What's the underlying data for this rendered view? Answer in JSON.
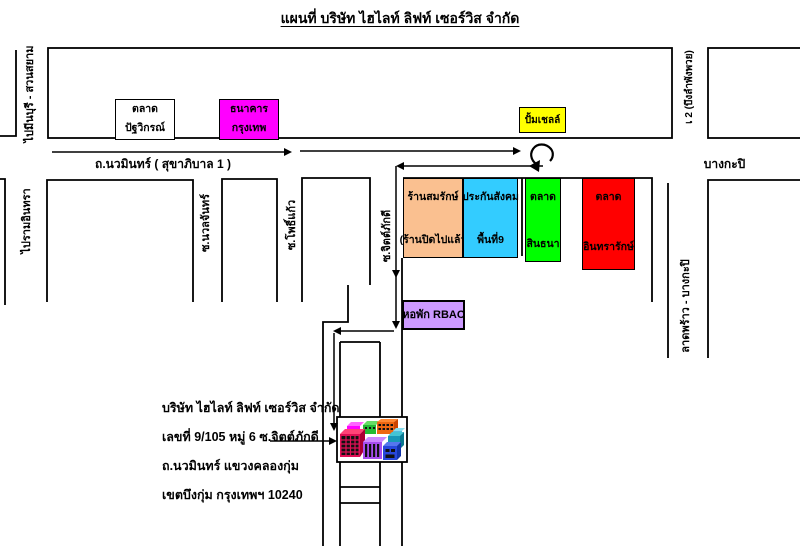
{
  "title": "แผนที่ บริษัท ไฮไลท์ ลิฟท์ เซอร์วิส จำกัด",
  "roads": {
    "main_road": "ถ.นวมินทร์ ( สุขาภิบาล 1 )",
    "to_minburi": "ไปมีนบุรี - สวนสยาม",
    "to_ramintra": "ไปรามอินทรา",
    "bueng_lam_phang_phuai": "เ 2 (บึงลำพังพวย)",
    "bangkapi": "บางกะปิ",
    "latphrao_bangkapi": "ลาดพร้าว - บางกะปิ",
    "soi_nuanchan": "ซ.นวลจันทร์",
    "soi_phokaeo": "ซ.โพธิ์แก้ว",
    "soi_chitphakdi": "ซ.จิตต์ภักดี"
  },
  "landmarks": {
    "market_patwikon": {
      "line1": "ตลาด",
      "line2": "ปัฐวิกรณ์",
      "color": "#FFFFFF"
    },
    "bangkok_bank": {
      "line1": "ธนาคาร",
      "line2": "กรุงเทพ",
      "color": "#FF00FF"
    },
    "shell_station": {
      "label": "ปั้มเชลล์",
      "color": "#FFFF00"
    },
    "somrak_shop": {
      "line1": "ร้านสมรักษ์",
      "line2": "(ร้านปิดไปแล้ว",
      "color": "#FAC090"
    },
    "social_security": {
      "line1": "ประกันสังคม",
      "line2": "พื้นที่9",
      "color": "#33CCFF"
    },
    "sinthana_market": {
      "line1": "ตลาด",
      "line2": "สินธนา",
      "color": "#00FF00"
    },
    "inthararak_market": {
      "line1": "ตลาด",
      "line2": "อินทรารักษ์",
      "color": "#FF0000"
    },
    "rbac_dorm": {
      "label": "หอพัก RBAC",
      "color": "#CC99FF"
    }
  },
  "company": {
    "line1": "บริษัท ไฮไลท์ ลิฟท์ เซอร์วิส จำกัด",
    "line2": "เลขที่ 9/105 หมู่ 6 ซ.จิตต์ภักดี",
    "line3": "ถ.นวมินทร์ แขวงคลองกุ่ม",
    "line4": "เขตบึงกุ่ม กรุงเทพฯ 10240"
  }
}
